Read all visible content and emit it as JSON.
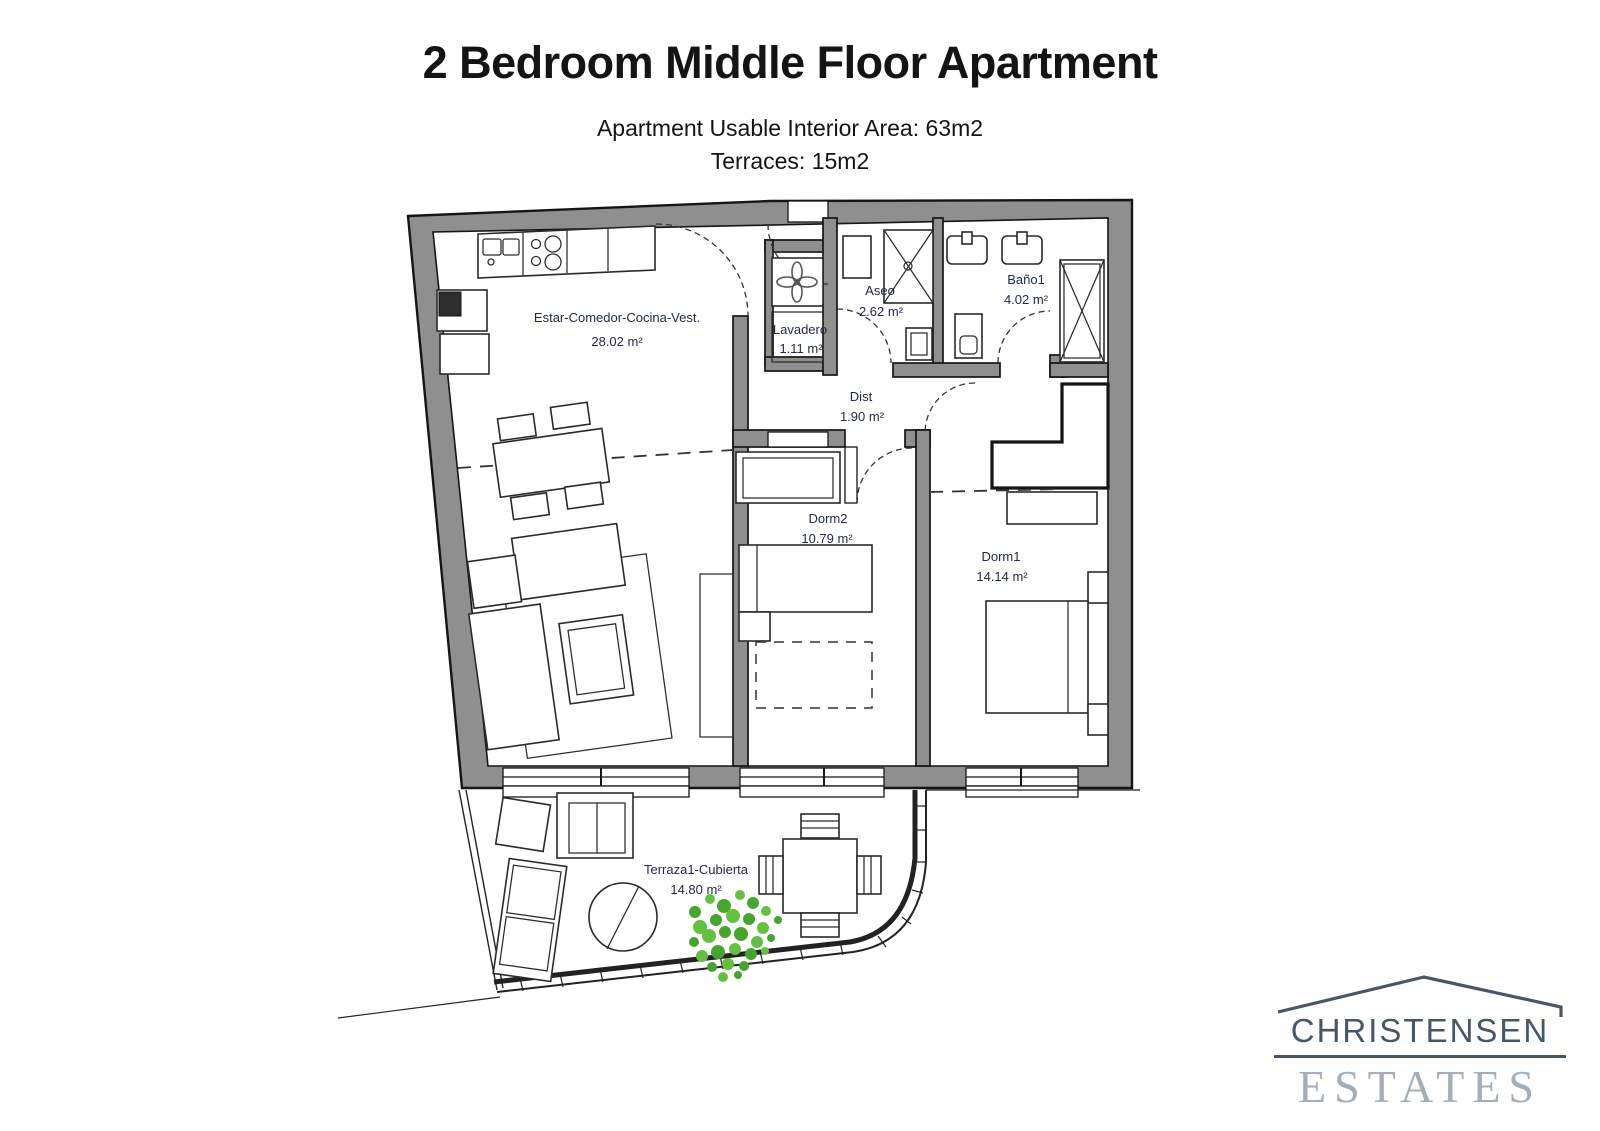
{
  "header": {
    "title": "2 Bedroom Middle Floor Apartment",
    "subtitle1": "Apartment Usable Interior Area: 63m2",
    "subtitle2": "Terraces: 15m2"
  },
  "floorplan": {
    "rooms": [
      {
        "id": "living",
        "name": "Estar-Comedor-Cocina-Vest.",
        "area": "28.02 m²"
      },
      {
        "id": "lavadero",
        "name": "Lavadero",
        "area": "1.11 m²"
      },
      {
        "id": "aseo",
        "name": "Aseo",
        "area": "2.62 m²"
      },
      {
        "id": "bano1",
        "name": "Baño1",
        "area": "4.02 m²"
      },
      {
        "id": "dist",
        "name": "Dist",
        "area": "1.90 m²"
      },
      {
        "id": "dorm2",
        "name": "Dorm2",
        "area": "10.79 m²"
      },
      {
        "id": "dorm1",
        "name": "Dorm1",
        "area": "14.14 m²"
      },
      {
        "id": "terraza",
        "name": "Terraza1-Cubierta",
        "area": "14.80 m²"
      }
    ],
    "colors": {
      "wall": "#8f8f8f",
      "label": "#202a4e",
      "plant1": "#46a52e",
      "plant2": "#63c13f",
      "logoDark": "#46566b",
      "logoLight": "#a4aeb9"
    }
  },
  "logo": {
    "name1": "CHRISTENSEN",
    "name2": "ESTATES"
  }
}
